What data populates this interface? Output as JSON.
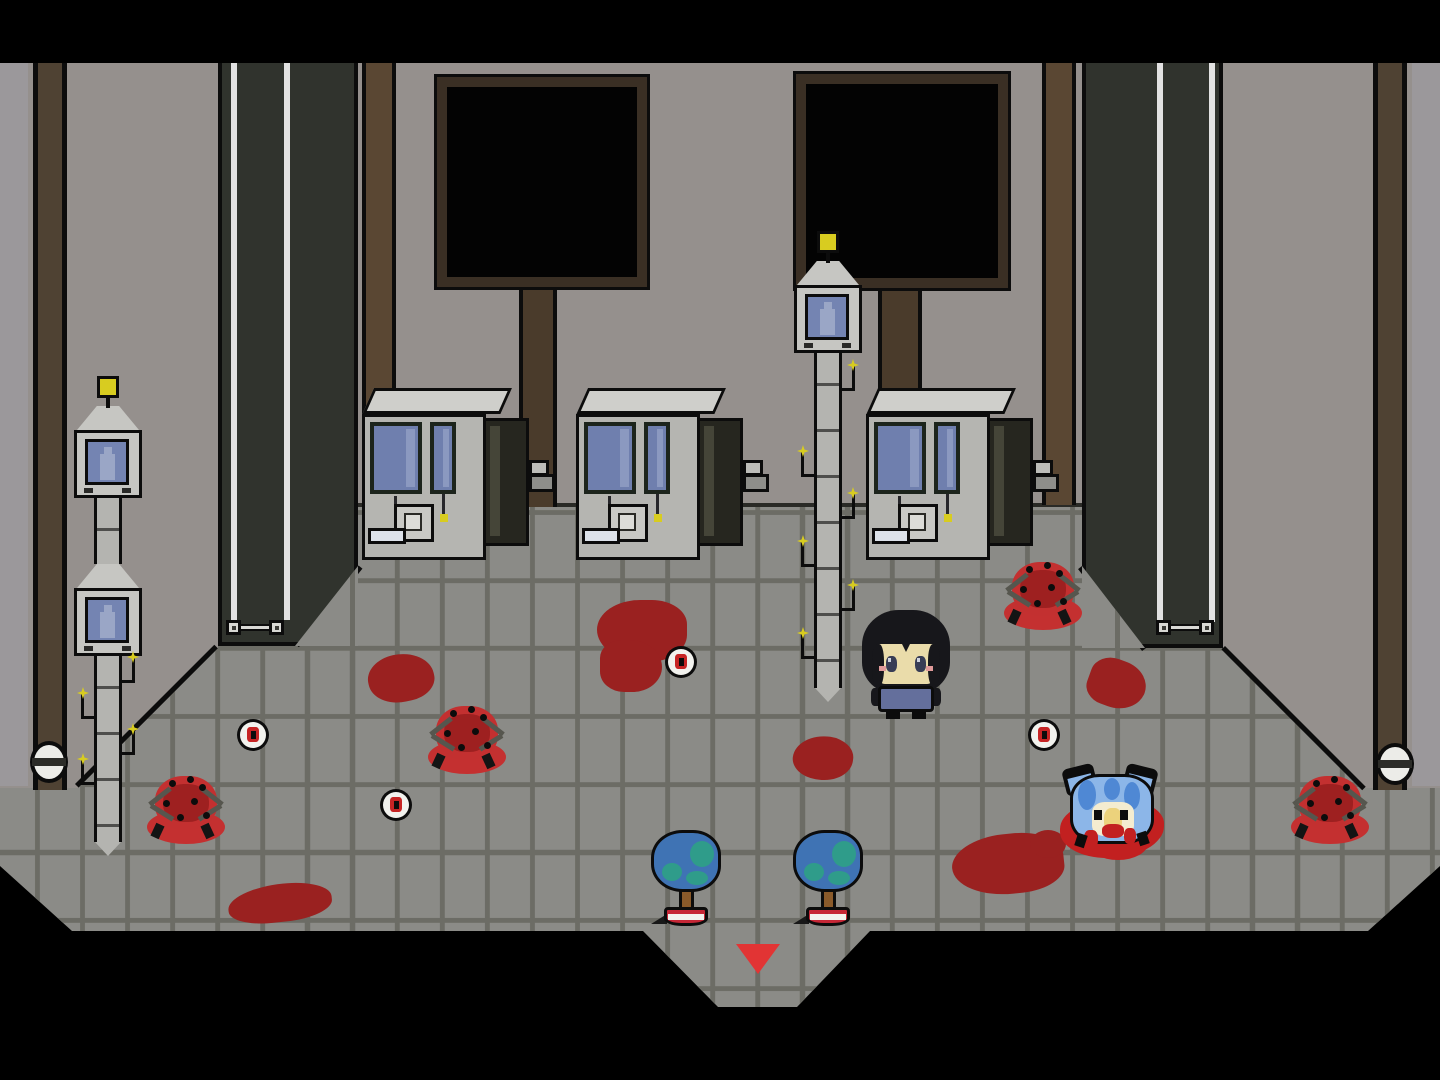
{
  "meta": {
    "app": "pixel-rpg-room",
    "description": "top-down pixel horror room: gray tiled hall with vending machines, surveillance towers, blood stains, eyeball items, spider creatures, a player character, a blue cat creature and a red exit arrow"
  },
  "palette": {
    "letterbox": "#000000",
    "wall": "#95908d",
    "wall_left_strip": "#9b989b",
    "floor": "#8b8b87",
    "grout": "#6c6c65",
    "outline": "#0c0c0c",
    "column_dark": "#30332d",
    "column_stripe": "#e2e2e2",
    "brown": "#5a4733",
    "brown_side": "#4f4233",
    "screen_frame": "#3a2f24",
    "screen_black": "#030303",
    "post": "#4a3b2b",
    "machine_body": "#b5b5b1",
    "machine_top": "#cfcfcb",
    "machine_window": "#6f7fae",
    "machine_window_hi": "#8b99c0",
    "window_frame": "#1c241c",
    "cabinet": "#26261f",
    "cabinet_hi": "#454538",
    "panel": "#c9c9c5",
    "slot": "#dde2ea",
    "pole": "#b4b4b0",
    "pole_head": "#c6c6c2",
    "cam_screen": "#7484b2",
    "cam_figure": "#9aa6c6",
    "light_yellow": "#d8cc20",
    "blood": "#9a2120",
    "spider_red": "#c33030",
    "spider_dark": "#9e2020",
    "spider_pool": "#c43030",
    "leg_gray": "#56564e",
    "eye_white": "#f2f2ee",
    "iris_red": "#c62424",
    "tree_blue": "#3f73b4",
    "tree_teal": "#2f9c8a",
    "trunk": "#8a5a2a",
    "pot_red": "#c62736",
    "pot_stripe": "#f2f2ee",
    "player_hair": "#17171b",
    "player_skin": "#eadcaa",
    "player_shirt": "#646f9c",
    "player_eye": "#383d55",
    "cheek_pink": "#e09a9a",
    "cat_blue": "#8cb6e8",
    "cat_hair": "#4f88d4",
    "cat_face": "#f4ecd0",
    "cat_face_in": "#ecd27c",
    "cat_blood": "#c22020",
    "arrow_red": "#e23434",
    "bracket_light": "#d8d8d4",
    "bolt_white": "#ececе8"
  },
  "layout": {
    "letterbox_top": {
      "x": 0,
      "y": 0,
      "w": 1440,
      "h": 63
    },
    "wall": {
      "x": 0,
      "y": 63,
      "w": 1440,
      "h": 810,
      "clip": "0 0,1440 0,1440 803,1223 585,218 585,0 803"
    },
    "floor": {
      "clip": "218 505,1222 505,1222 648,1362 788,1440 788,1440 866,1368 931,870 931,797 1007,718 1007,643 931,72 931,0 866,0 788,78 788,218 648",
      "tile_w": 45,
      "tile_h": 68,
      "line": 5,
      "offset_x": 35,
      "offset_y": 34
    },
    "wall_floor_line": {
      "x": 358,
      "y": 503,
      "w": 724,
      "h": 4
    },
    "diagonal_edges": [
      {
        "x": 75,
        "y": 784,
        "len": 197,
        "deg": -45
      },
      {
        "x": 1225,
        "y": 646,
        "len": 199,
        "deg": 45
      },
      {
        "x": 295,
        "y": 644,
        "len": 101,
        "deg": -51
      },
      {
        "x": 1082,
        "y": 566,
        "len": 104,
        "deg": 52
      }
    ]
  },
  "entities": {
    "pillars": [
      {
        "x": 218,
        "y": 63,
        "w": 140,
        "h": 583,
        "stripes": [
          9,
          62
        ],
        "patch": {
          "x": 295,
          "y": 566,
          "w": 63,
          "h": 80,
          "clip": "63 0,63 80,0 80",
          "grout_x": 55
        }
      },
      {
        "x": 1082,
        "y": 63,
        "w": 141,
        "h": 585,
        "stripes": [
          71,
          123
        ],
        "patch": {
          "x": 1082,
          "y": 566,
          "w": 63,
          "h": 82,
          "clip": "0 0,63 82,0 82",
          "grout_x": 33
        }
      }
    ],
    "brackets": [
      {
        "x": 226,
        "y": 620
      },
      {
        "x": 1156,
        "y": 620
      }
    ],
    "inner_brown_stripes": [
      {
        "x": 362,
        "y": 63,
        "w": 34,
        "h": 442
      },
      {
        "x": 1042,
        "y": 63,
        "w": 34,
        "h": 442
      }
    ],
    "side_wall_strips": [
      {
        "x": 0,
        "y": 63,
        "w": 28,
        "h": 723
      },
      {
        "x": 1412,
        "y": 63,
        "w": 28,
        "h": 723
      }
    ],
    "side_brown_columns": [
      {
        "x": 33,
        "y": 63,
        "w": 34,
        "h": 727
      },
      {
        "x": 1373,
        "y": 63,
        "w": 34,
        "h": 727
      }
    ],
    "bolts": [
      {
        "x": 30,
        "y": 741
      },
      {
        "x": 1376,
        "y": 743
      }
    ],
    "screens": [
      {
        "x": 437,
        "y": 77,
        "w": 210,
        "h": 210
      },
      {
        "x": 796,
        "y": 74,
        "w": 212,
        "h": 214
      }
    ],
    "posts": [
      {
        "x": 519,
        "y": 285,
        "w": 38,
        "h": 222
      },
      {
        "x": 878,
        "y": 286,
        "w": 44,
        "h": 110
      }
    ],
    "machines": [
      {
        "x": 362,
        "y": 388
      },
      {
        "x": 576,
        "y": 388
      },
      {
        "x": 866,
        "y": 388
      }
    ],
    "towers": [
      {
        "cx": 108,
        "light_y": 376,
        "units": [
          {
            "head_y": 406,
            "mon_y": 430
          },
          {
            "head_y": 564,
            "mon_y": 588
          }
        ],
        "poles": [
          {
            "y": 498,
            "h": 66
          },
          {
            "y": 656,
            "h": 186
          }
        ],
        "tip_y": 842,
        "hooks": [
          {
            "s": "r",
            "y": 664
          },
          {
            "s": "l",
            "y": 700
          },
          {
            "s": "r",
            "y": 736
          },
          {
            "s": "l",
            "y": 766
          }
        ]
      },
      {
        "cx": 828,
        "light_y": 231,
        "units": [
          {
            "head_y": 261,
            "mon_y": 285
          }
        ],
        "poles": [
          {
            "y": 353,
            "h": 335
          }
        ],
        "tip_y": 688,
        "hooks": [
          {
            "s": "r",
            "y": 372
          },
          {
            "s": "l",
            "y": 458
          },
          {
            "s": "r",
            "y": 500
          },
          {
            "s": "l",
            "y": 548
          },
          {
            "s": "r",
            "y": 592
          },
          {
            "s": "l",
            "y": 640
          }
        ]
      }
    ],
    "blood_stains": [
      {
        "x": 597,
        "y": 600,
        "w": 90,
        "h": 62,
        "rot": 0,
        "br": "55% 45% 50% 60%"
      },
      {
        "x": 600,
        "y": 640,
        "w": 62,
        "h": 52,
        "rot": 0,
        "br": "40% 60% 55% 45%"
      },
      {
        "x": 368,
        "y": 654,
        "w": 66,
        "h": 48,
        "rot": -12,
        "br": "50% 60% 45% 55%"
      },
      {
        "x": 793,
        "y": 736,
        "w": 60,
        "h": 44,
        "rot": 8,
        "br": "60% 45% 55% 45%"
      },
      {
        "x": 952,
        "y": 834,
        "w": 112,
        "h": 60,
        "rot": -6,
        "br": "55% 50% 45% 60%"
      },
      {
        "x": 1030,
        "y": 830,
        "w": 36,
        "h": 28,
        "rot": 0,
        "br": "50%"
      },
      {
        "x": 1088,
        "y": 660,
        "w": 58,
        "h": 48,
        "rot": 20,
        "br": "45% 55% 60% 40%"
      },
      {
        "x": 228,
        "y": 884,
        "w": 104,
        "h": 38,
        "rot": -6,
        "br": "60% 50% 50% 45%"
      }
    ],
    "spiders": [
      {
        "x": 147,
        "y": 770
      },
      {
        "x": 428,
        "y": 700
      },
      {
        "x": 1004,
        "y": 556
      },
      {
        "x": 1291,
        "y": 770
      }
    ],
    "eyeballs": [
      {
        "x": 237,
        "y": 719
      },
      {
        "x": 380,
        "y": 789
      },
      {
        "x": 665,
        "y": 646
      },
      {
        "x": 1028,
        "y": 719
      }
    ],
    "trees": [
      {
        "x": 651,
        "y": 830
      },
      {
        "x": 793,
        "y": 830
      }
    ],
    "player": {
      "x": 862,
      "y": 604
    },
    "cat": {
      "x": 1058,
      "y": 766
    },
    "exit_arrow": {
      "x": 736,
      "y": 944,
      "w": 44,
      "h": 30
    }
  }
}
